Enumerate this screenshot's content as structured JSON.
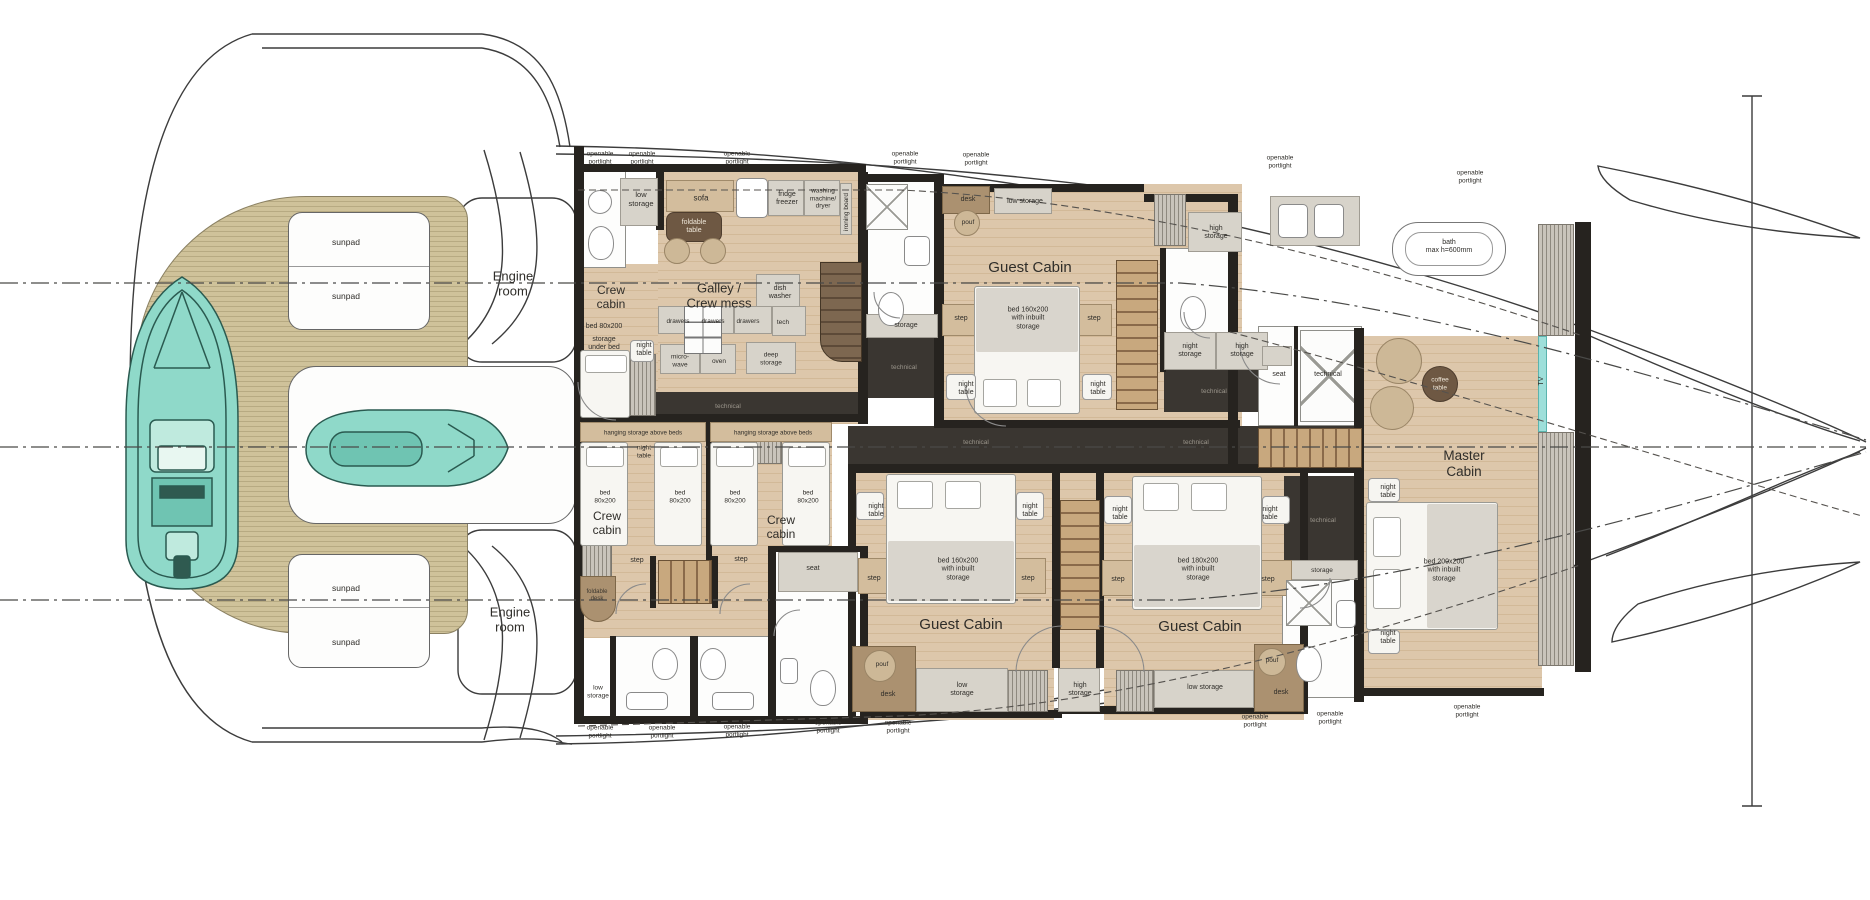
{
  "title": "Yacht lower deck floor plan",
  "colors": {
    "wood_floor": "#d8c0a0",
    "teak_deck": "#c8bb93",
    "bulkhead": "#26231f",
    "technical_floor": "#3a3631",
    "cabinet": "#d7d3ca",
    "furniture_brown": "#6e5843",
    "tender_teal": "#84d7c6",
    "tv_wall_cyan": "#9edfda",
    "label_ink": "#2f2d29"
  },
  "portlights": {
    "text": "openable\nportlight",
    "top": [
      {
        "x": 600,
        "y": 158
      },
      {
        "x": 642,
        "y": 158
      },
      {
        "x": 737,
        "y": 158
      },
      {
        "x": 905,
        "y": 158
      },
      {
        "x": 976,
        "y": 159
      },
      {
        "x": 1280,
        "y": 162
      },
      {
        "x": 1470,
        "y": 177
      }
    ],
    "bottom": [
      {
        "x": 600,
        "y": 732
      },
      {
        "x": 662,
        "y": 732
      },
      {
        "x": 737,
        "y": 731
      },
      {
        "x": 828,
        "y": 727
      },
      {
        "x": 898,
        "y": 727
      },
      {
        "x": 1255,
        "y": 721
      },
      {
        "x": 1330,
        "y": 718
      },
      {
        "x": 1467,
        "y": 711
      }
    ]
  },
  "labels": [
    {
      "id": "engine-room-top",
      "t": "Engine\nroom",
      "x": 513,
      "y": 284,
      "s": 13
    },
    {
      "id": "engine-room-bottom",
      "t": "Engine\nroom",
      "x": 510,
      "y": 620,
      "s": 13
    },
    {
      "id": "sunpad-1",
      "t": "sunpad",
      "x": 346,
      "y": 242,
      "s": 8.5
    },
    {
      "id": "sunpad-2",
      "t": "sunpad",
      "x": 346,
      "y": 296,
      "s": 8.5
    },
    {
      "id": "sunpad-3",
      "t": "sunpad",
      "x": 346,
      "y": 588,
      "s": 8.5
    },
    {
      "id": "sunpad-4",
      "t": "sunpad",
      "x": 346,
      "y": 642,
      "s": 8.5
    },
    {
      "id": "low-storage-fwd",
      "t": "low\nstorage",
      "x": 641,
      "y": 200,
      "s": 7.5
    },
    {
      "id": "crew-cabin-fwd",
      "t": "Crew\ncabin",
      "x": 611,
      "y": 297,
      "s": 12
    },
    {
      "id": "bed-80x200-fwd",
      "t": "bed 80x200",
      "x": 604,
      "y": 327,
      "s": 7
    },
    {
      "id": "storage-under-bed",
      "t": "storage\nunder bed",
      "x": 604,
      "y": 344,
      "s": 7
    },
    {
      "id": "night-table-fwd",
      "t": "night\ntable",
      "x": 644,
      "y": 350,
      "s": 7
    },
    {
      "id": "sofa",
      "t": "sofa",
      "x": 701,
      "y": 198,
      "s": 8
    },
    {
      "id": "foldable-table",
      "t": "foldable\ntable",
      "x": 694,
      "y": 227,
      "s": 7,
      "c": "#efe7d9"
    },
    {
      "id": "fridge-freezer",
      "t": "fridge\nfreezer",
      "x": 787,
      "y": 199,
      "s": 7
    },
    {
      "id": "washing-machine-dryer",
      "t": "washing\nmachine/\ndryer",
      "x": 823,
      "y": 199,
      "s": 6.5
    },
    {
      "id": "ironing-board",
      "t": "ironing board",
      "x": 847,
      "y": 212,
      "s": 6.5,
      "r": 1
    },
    {
      "id": "galley-crew-mess",
      "t": "Galley /\nCrew mess",
      "x": 719,
      "y": 296,
      "s": 13
    },
    {
      "id": "dish-washer",
      "t": "dish\nwasher",
      "x": 780,
      "y": 293,
      "s": 7
    },
    {
      "id": "drawers-1",
      "t": "drawers",
      "x": 678,
      "y": 322,
      "s": 6.5
    },
    {
      "id": "drawers-2",
      "t": "drawers",
      "x": 713,
      "y": 322,
      "s": 6.5
    },
    {
      "id": "drawers-3",
      "t": "drawers",
      "x": 748,
      "y": 322,
      "s": 6.5
    },
    {
      "id": "tech",
      "t": "tech",
      "x": 783,
      "y": 323,
      "s": 6.5
    },
    {
      "id": "microwave",
      "t": "micro-\nwave",
      "x": 680,
      "y": 361,
      "s": 6.5
    },
    {
      "id": "oven",
      "t": "oven",
      "x": 719,
      "y": 362,
      "s": 6.5
    },
    {
      "id": "deep-storage",
      "t": "deep\nstorage",
      "x": 771,
      "y": 359,
      "s": 6.5
    },
    {
      "id": "technical-galley",
      "t": "technical",
      "x": 728,
      "y": 407,
      "s": 6.5,
      "c": "#9b968c"
    },
    {
      "id": "storage-bath-fwd",
      "t": "storage",
      "x": 906,
      "y": 326,
      "s": 7
    },
    {
      "id": "technical-bath-fwd",
      "t": "technical",
      "x": 904,
      "y": 368,
      "s": 6.5,
      "c": "#9b968c"
    },
    {
      "id": "desk-guest-fwd",
      "t": "desk",
      "x": 968,
      "y": 200,
      "s": 7
    },
    {
      "id": "pouf-guest-fwd",
      "t": "pouf",
      "x": 968,
      "y": 223,
      "s": 6.5
    },
    {
      "id": "low-storage-guest-fwd",
      "t": "low storage",
      "x": 1025,
      "y": 202,
      "s": 7
    },
    {
      "id": "guest-cabin-fwd",
      "t": "Guest Cabin",
      "x": 1030,
      "y": 268,
      "s": 15
    },
    {
      "id": "bed-160-guest-fwd",
      "t": "bed 160x200\nwith inbuilt\nstorage",
      "x": 1028,
      "y": 319,
      "s": 7
    },
    {
      "id": "step-guest-fwd-left",
      "t": "step",
      "x": 961,
      "y": 319,
      "s": 7
    },
    {
      "id": "step-guest-fwd-right",
      "t": "step",
      "x": 1094,
      "y": 319,
      "s": 7
    },
    {
      "id": "night-table-guest-fwd-left",
      "t": "night\ntable",
      "x": 966,
      "y": 389,
      "s": 7
    },
    {
      "id": "night-table-guest-fwd-right",
      "t": "night\ntable",
      "x": 1098,
      "y": 389,
      "s": 7
    },
    {
      "id": "high-storage-guest-fwd",
      "t": "high\nstorage",
      "x": 1216,
      "y": 233,
      "s": 7
    },
    {
      "id": "night-storage-mid",
      "t": "night\nstorage",
      "x": 1190,
      "y": 351,
      "s": 7
    },
    {
      "id": "high-storage-mid",
      "t": "high\nstorage",
      "x": 1242,
      "y": 351,
      "s": 7
    },
    {
      "id": "seat-mid",
      "t": "seat",
      "x": 1279,
      "y": 375,
      "s": 7
    },
    {
      "id": "technical-mid-white",
      "t": "technical",
      "x": 1328,
      "y": 375,
      "s": 7
    },
    {
      "id": "technical-mid-dark",
      "t": "technical",
      "x": 1214,
      "y": 392,
      "s": 6.5,
      "c": "#9b968c"
    },
    {
      "id": "technical-corridor-1",
      "t": "technical",
      "x": 976,
      "y": 443,
      "s": 6.5,
      "c": "#9b968c"
    },
    {
      "id": "technical-corridor-2",
      "t": "technical",
      "x": 1196,
      "y": 443,
      "s": 6.5,
      "c": "#9b968c"
    },
    {
      "id": "bath-max-height",
      "t": "bath\nmax h=600mm",
      "x": 1449,
      "y": 247,
      "s": 7
    },
    {
      "id": "coffee-table",
      "t": "coffee\ntable",
      "x": 1440,
      "y": 384,
      "s": 6.5,
      "c": "#efe7d9"
    },
    {
      "id": "tv",
      "t": "TV",
      "x": 1542,
      "y": 381,
      "s": 7,
      "r": 1
    },
    {
      "id": "master-cabin",
      "t": "Master\nCabin",
      "x": 1464,
      "y": 464,
      "s": 13.5
    },
    {
      "id": "night-table-master-top",
      "t": "night\ntable",
      "x": 1388,
      "y": 492,
      "s": 7
    },
    {
      "id": "bed-200-master",
      "t": "bed 200x200\nwith inbuilt\nstorage",
      "x": 1444,
      "y": 571,
      "s": 7
    },
    {
      "id": "night-table-master-bottom",
      "t": "night\ntable",
      "x": 1388,
      "y": 638,
      "s": 7
    },
    {
      "id": "technical-master",
      "t": "technical",
      "x": 1323,
      "y": 521,
      "s": 6.5,
      "c": "#9b968c"
    },
    {
      "id": "storage-master-bath",
      "t": "storage",
      "x": 1322,
      "y": 571,
      "s": 6.5
    },
    {
      "id": "hanging-storage-crew-1",
      "t": "hanging storage above beds",
      "x": 643,
      "y": 433,
      "s": 6.2
    },
    {
      "id": "hanging-storage-crew-2",
      "t": "hanging storage above beds",
      "x": 773,
      "y": 433,
      "s": 6.2
    },
    {
      "id": "night-table-crew",
      "t": "night\ntable",
      "x": 644,
      "y": 452,
      "s": 6.5
    },
    {
      "id": "bed-80-crew1a",
      "t": "bed\n80x200",
      "x": 605,
      "y": 497,
      "s": 6.5
    },
    {
      "id": "bed-80-crew1b",
      "t": "bed\n80x200",
      "x": 680,
      "y": 497,
      "s": 6.5
    },
    {
      "id": "crew-cabin-1",
      "t": "Crew\ncabin",
      "x": 607,
      "y": 523,
      "s": 12
    },
    {
      "id": "bed-80-crew2a",
      "t": "bed\n80x200",
      "x": 735,
      "y": 497,
      "s": 6.5
    },
    {
      "id": "bed-80-crew2b",
      "t": "bed\n80x200",
      "x": 808,
      "y": 497,
      "s": 6.5
    },
    {
      "id": "crew-cabin-2",
      "t": "Crew\ncabin",
      "x": 781,
      "y": 527,
      "s": 12
    },
    {
      "id": "step-crew-1",
      "t": "step",
      "x": 637,
      "y": 561,
      "s": 7
    },
    {
      "id": "step-crew-2",
      "t": "step",
      "x": 741,
      "y": 560,
      "s": 7
    },
    {
      "id": "foldable-desk",
      "t": "foldable\ndesk",
      "x": 597,
      "y": 596,
      "s": 6,
      "c": "#3c372f"
    },
    {
      "id": "seat-aft",
      "t": "seat",
      "x": 813,
      "y": 569,
      "s": 7
    },
    {
      "id": "low-storage-aft",
      "t": "low\nstorage",
      "x": 598,
      "y": 692,
      "s": 6.5
    },
    {
      "id": "night-table-guest2-left",
      "t": "night\ntable",
      "x": 876,
      "y": 511,
      "s": 7
    },
    {
      "id": "night-table-guest2-right",
      "t": "night\ntable",
      "x": 1030,
      "y": 511,
      "s": 7
    },
    {
      "id": "step-guest2-left",
      "t": "step",
      "x": 874,
      "y": 579,
      "s": 7
    },
    {
      "id": "step-guest2-right",
      "t": "step",
      "x": 1028,
      "y": 579,
      "s": 7
    },
    {
      "id": "bed-160-guest2",
      "t": "bed 160x200\nwith inbuilt\nstorage",
      "x": 958,
      "y": 570,
      "s": 7
    },
    {
      "id": "guest-cabin-2",
      "t": "Guest Cabin",
      "x": 961,
      "y": 625,
      "s": 15
    },
    {
      "id": "pouf-guest2",
      "t": "pouf",
      "x": 882,
      "y": 665,
      "s": 6.5
    },
    {
      "id": "desk-guest2",
      "t": "desk",
      "x": 888,
      "y": 695,
      "s": 7
    },
    {
      "id": "low-storage-guest2",
      "t": "low\nstorage",
      "x": 962,
      "y": 690,
      "s": 7
    },
    {
      "id": "high-storage-aft",
      "t": "high\nstorage",
      "x": 1080,
      "y": 690,
      "s": 7
    },
    {
      "id": "low-storage-guest3",
      "t": "low storage",
      "x": 1205,
      "y": 688,
      "s": 7
    },
    {
      "id": "night-table-guest3-left",
      "t": "night\ntable",
      "x": 1120,
      "y": 514,
      "s": 7
    },
    {
      "id": "night-table-guest3-right",
      "t": "night\ntable",
      "x": 1270,
      "y": 514,
      "s": 7
    },
    {
      "id": "step-guest3-left",
      "t": "step",
      "x": 1118,
      "y": 580,
      "s": 7
    },
    {
      "id": "step-guest3-right",
      "t": "step",
      "x": 1268,
      "y": 580,
      "s": 7
    },
    {
      "id": "bed-180-guest3",
      "t": "bed 180x200\nwith inbuilt\nstorage",
      "x": 1198,
      "y": 570,
      "s": 7
    },
    {
      "id": "guest-cabin-3",
      "t": "Guest Cabin",
      "x": 1200,
      "y": 627,
      "s": 15
    },
    {
      "id": "pouf-guest3",
      "t": "pouf",
      "x": 1272,
      "y": 661,
      "s": 6.5
    },
    {
      "id": "desk-guest3",
      "t": "desk",
      "x": 1281,
      "y": 693,
      "s": 7
    }
  ]
}
